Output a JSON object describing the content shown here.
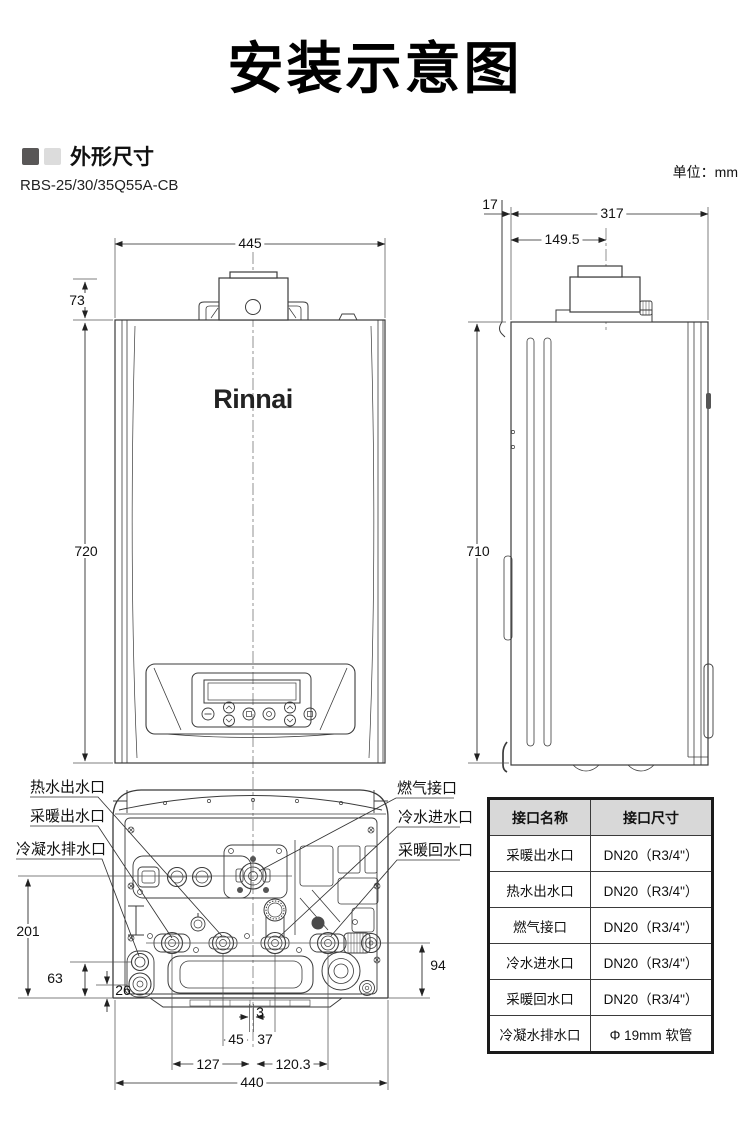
{
  "page": {
    "title": "安装示意图",
    "unit_note": "单位：mm"
  },
  "section": {
    "title": "外形尺寸",
    "model": "RBS-25/30/35Q55A-CB"
  },
  "front_view": {
    "brand_logo": "Rinnai",
    "dims": {
      "width": "445",
      "flue_height": "73",
      "height": "720"
    }
  },
  "side_view": {
    "dims": {
      "wall_gap": "17",
      "depth": "317",
      "flue_center_offset": "149.5",
      "height": "710"
    }
  },
  "bottom_view": {
    "labels": {
      "hot_water_outlet": "热水出水口",
      "heating_water_outlet": "采暖出水口",
      "condensate_drain_outlet": "冷凝水排水口",
      "gas_connection": "燃气接口",
      "cold_water_inlet": "冷水进水口",
      "heating_water_return": "采暖回水口"
    },
    "dims": {
      "gas_port_height": "201",
      "drain_upper_height": "63",
      "drain_lower_height": "26",
      "ports_height": "94",
      "center_offset": "3",
      "hot_to_center": "45",
      "center_to_cold": "37",
      "heating_to_center": "127",
      "center_to_return": "120.3",
      "width": "440"
    }
  },
  "connection_table": {
    "headers": [
      "接口名称",
      "接口尺寸"
    ],
    "rows": [
      {
        "name": "采暖出水口",
        "size": "DN20（R3/4\"）"
      },
      {
        "name": "热水出水口",
        "size": "DN20（R3/4\"）"
      },
      {
        "name": "燃气接口",
        "size": "DN20（R3/4\"）"
      },
      {
        "name": "冷水进水口",
        "size": "DN20（R3/4\"）"
      },
      {
        "name": "采暖回水口",
        "size": "DN20（R3/4\"）"
      },
      {
        "name": "冷凝水排水口",
        "size": "Φ 19mm 软管"
      }
    ]
  }
}
